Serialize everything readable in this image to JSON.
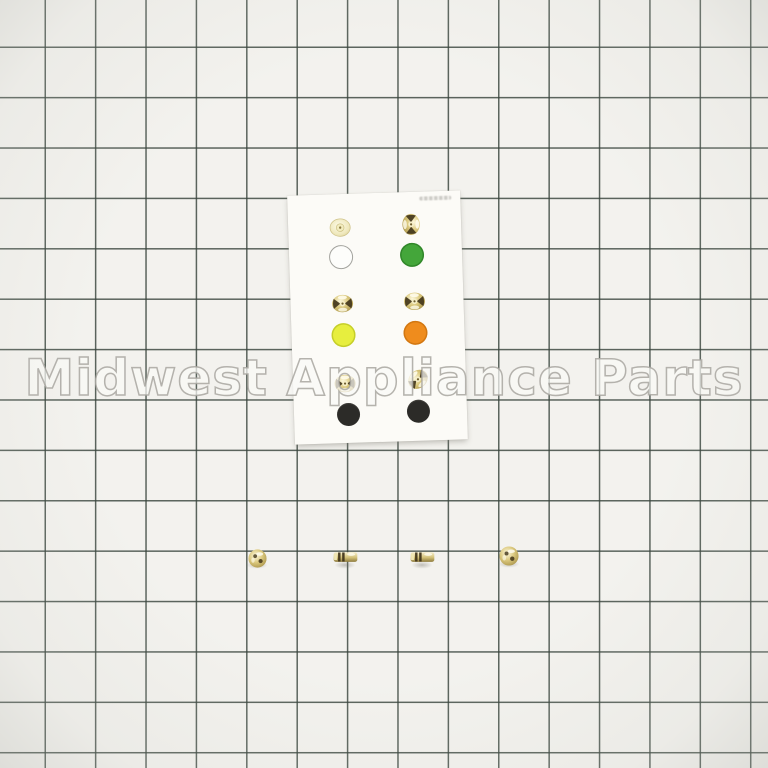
{
  "photo": {
    "alt": "gas orifice sample card with colored code dots and four loose brass orifices on green grid paper"
  },
  "watermark": {
    "text": "Midwest Appliance Parts"
  },
  "colors": {
    "paper": "#f3f2ee",
    "grid_line": "rgba(56,68,60,0.82)",
    "card": "#fcfbf7",
    "watermark_fill": "rgba(250,249,246,0.72)",
    "watermark_stroke": "rgba(168,166,160,0.85)",
    "dot_white": "#fdfdfb",
    "dot_white_outline": "#a3a39e",
    "dot_green": "#44a63a",
    "dot_yellow": "#e7ee3e",
    "dot_orange": "#ef8c1d",
    "dot_black": "#2c2b28",
    "brass_light": "#f8f1cf",
    "brass_mid": "#d3c178",
    "brass_dark": "#8f7c3e",
    "brass_mark": "#3f3319"
  },
  "card_items": {
    "rows": [
      {
        "left": "brass-orifice-pale-top-view",
        "right": "brass-orifice-top-view"
      },
      {
        "left": "white-dot",
        "right": "green-dot"
      },
      {
        "left": "brass-orifice-top-view",
        "right": "brass-orifice-top-view"
      },
      {
        "left": "yellow-dot",
        "right": "orange-dot"
      },
      {
        "left": "brass-orifice-top-view",
        "right": "brass-orifice-top-view"
      },
      {
        "left": "black-dot",
        "right": "black-dot"
      }
    ]
  },
  "loose_parts": [
    "brass-orifice-ball-view",
    "brass-orifice-side-view",
    "brass-orifice-side-view",
    "brass-orifice-ball-view"
  ]
}
